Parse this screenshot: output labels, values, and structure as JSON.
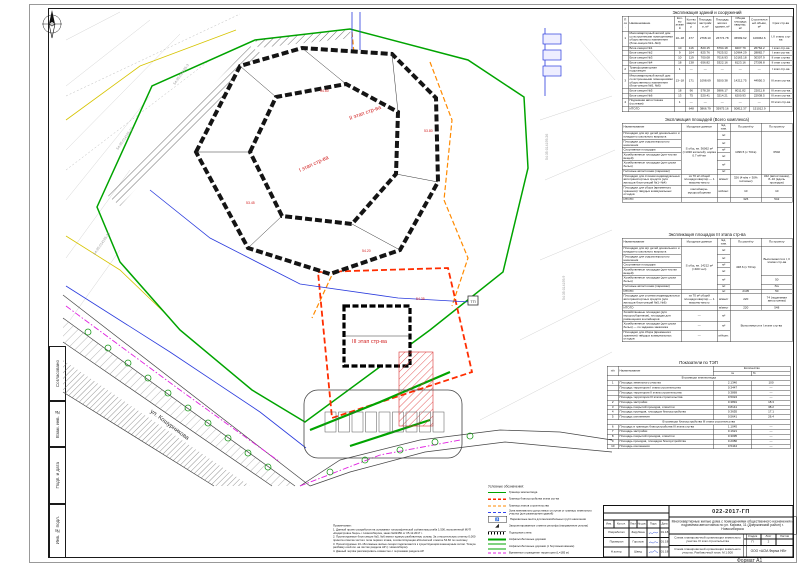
{
  "sheet": {
    "format_label": "Формат А1"
  },
  "side_stamp": {
    "cells": [
      "Согласовано",
      "Взам. инв. №",
      "Подп. и дата",
      "Инв. № подл."
    ]
  },
  "drawing": {
    "street_label": "ул. Кошурникова",
    "tp_label": "ТП",
    "stage_labels": [
      "I этап стр-ва",
      "II этап стр-ва",
      "III этап стр-ва"
    ],
    "elevation_marks": [
      "54.60",
      "53.80",
      "54.20",
      "53.45",
      "54.35"
    ],
    "cadastral_labels": [
      "54:35:014195:17",
      "54:35:014195:23",
      "54:35:014195:3",
      "54:35:014195:26",
      "54:35:014195:9"
    ]
  },
  "tables": {
    "buildings": {
      "title": "Экспликация зданий и сооружений",
      "rows": [
        [
          "Поз.",
          "Наименование",
          "Кол-во этажей",
          "Кол-во квартир",
          "Площадь застройки, м²",
          "Площадь жилого здания, м²",
          "Общая площадь квартир, м²",
          "Строительный объём, м³",
          "Срок стр-ва"
        ],
        [
          "1",
          "Многоквартирный жилой дом со встроенными помещениями общественного назначения (блок-секции №1–№4)",
          "10–18",
          "477",
          "2768.10",
          "26774.78",
          "36599.62",
          "106062.6",
          "I, II этапы стр-ва"
        ],
        [
          "",
          "Блок-секция №1",
          "10",
          "116",
          "820.15",
          "6794.18",
          "9207.79",
          "26762.2",
          "I этап стр-ва"
        ],
        [
          "",
          "Блок-секция №2",
          "9",
          "104",
          "825.76",
          "7625.52",
          "10964.29",
          "28882.7",
          "I этап стр-ва"
        ],
        [
          "",
          "Блок-секция №3",
          "10",
          "119",
          "700.08",
          "7016.93",
          "10163.18",
          "30307.9",
          "II этап стр-ва"
        ],
        [
          "",
          "Блок-секция №4",
          "18",
          "138",
          "656.82",
          "5322.16",
          "8123.16",
          "27309.8",
          "II этап стр-ва"
        ],
        [
          "2",
          "Трансформаторная подстанция",
          "1",
          "—",
          "—",
          "—",
          "—",
          "—",
          "I этап стр-ва"
        ],
        [
          "3",
          "Многоквартирный жилой дом со встроенными помещениями общественного назначения (блок-секции №5, №6)",
          "13–18",
          "171",
          "1098.69",
          "9200.38",
          "14212.75",
          "44950.3",
          "III этап стр-ва"
        ],
        [
          "",
          "Блок-секция №5",
          "18",
          "96",
          "578.28",
          "5986.17",
          "8011.82",
          "22011.8",
          "III этап стр-ва"
        ],
        [
          "",
          "Блок-секция №6",
          "13",
          "75",
          "520.41",
          "3214.21",
          "6200.93",
          "22938.5",
          "III этап стр-ва"
        ],
        [
          "4",
          "Подземная автостоянка (гостевая)",
          "1",
          "—",
          "—",
          "—",
          "—",
          "—",
          "III этап стр-ва"
        ],
        [
          "",
          "ИТОГО",
          "",
          "648",
          "3866.79",
          "35975.16",
          "50812.37",
          "151012.9",
          ""
        ]
      ]
    },
    "areas_total": {
      "title": "Экспликация площадей (Всего комплекса)",
      "rows": [
        [
          "Наименование",
          "Исходные данные",
          "Ед. изм.",
          "По расчёту",
          "По проекту"
        ],
        [
          "Площадки для игр детей дошкольного и младшего школьного возраста",
          {
            "v": "S общ. кв. 36062 м² (≈1030 жителей), норма 0.7 м²/чел",
            "rs": 6
          },
          "м²",
          {
            "v": "1096.5 (х 70/га)",
            "rs": 6
          },
          {
            "v": "6502",
            "rs": 6
          }
        ],
        [
          "Площадки для отдыха взрослого населения",
          "м²"
        ],
        [
          "Спортивные площадки",
          "м²"
        ],
        [
          "Хозяйственные площадки (для чистки вещей)",
          "м²"
        ],
        [
          "Хозяйственные площадки (для сушки белья)",
          "м²"
        ],
        [
          "Гостевые автостоянки (парковки)",
          "м²"
        ],
        [
          "Площадки для стоянки индивидуальных автотранспортных средств (для жильцов блок-секций №1–№4)",
          "из 70 м² общей площади квартир — 1 машино-место",
          "м/мест",
          "326 (4 м/м + 30% гостевых)",
          "342 (автостоянка), 8–10 (вдоль проездов)"
        ],
        [
          "Площадки для сбора (временного хранения) твёрдых коммунальных отходов",
          "контейнеры-мусоросборники",
          "м²/конт.",
          "10",
          "10"
        ],
        [
          "ИТОГО",
          "",
          "",
          "326",
          "542"
        ]
      ]
    },
    "areas_stage": {
      "title": "Экспликация площадок III этапа стр-ва",
      "rows": [
        [
          "Наименование",
          "Исходные данные",
          "Ед. изм.",
          "По расчёту",
          "По проекту"
        ],
        [
          "Площадки для игр детей дошкольного и младшего школьного возраста",
          {
            "v": "S общ. кв. 14212 м² (≈400 чел)",
            "rs": 6
          },
          "м²",
          {
            "v": "438.6 (х 70/га)",
            "rs": 6
          },
          {
            "v": "Выполняются в I, II этапах стр-ва",
            "rs": 4
          }
        ],
        [
          "Площадки для отдыха взрослого населения",
          "м²"
        ],
        [
          "Спортивные площадки",
          "м²"
        ],
        [
          "Хозяйственные площадки (для чистки вещей)",
          "м²"
        ],
        [
          "Хозяйственные площадки (для сушки белья)",
          "м²",
          "50"
        ],
        [
          "Гостевые автостоянки (парковки)",
          "м²",
          "б/н"
        ],
        [
          "ИТОГО",
          "",
          "м²",
          "2105",
          "50"
        ],
        [
          "Площадки для стоянки индивидуальных автотранспортных средств (для жильцов блок-секций №5, №6)",
          "из 70 м² общей площади квартир — 1 машино-место",
          "м/мест",
          "220",
          "74 (подземная автостоянка)"
        ],
        [
          "ИТОГО",
          "",
          "м/мест",
          "220",
          "548"
        ],
        [
          "Хозяйственные площадки (для мусоросборников), площадки для размещения контейнеров",
          "—",
          "м²",
          {
            "v": "Выполняются в I этапе стр-ва",
            "cs": 2,
            "rs": 3,
            "c": 1
          }
        ],
        [
          "Хозяйственные площадки (для сушки белья) — по заданию заказчика",
          "—",
          "м²"
        ],
        [
          "Площадки для сбора (временного хранения) твёрдых коммунальных отходов",
          "—",
          "м²/конт."
        ]
      ]
    },
    "tep": {
      "title": "Показатели по ТЭП",
      "rows": [
        [
          {
            "v": "п/п",
            "rs": 2
          },
          {
            "v": "Наименование",
            "rs": 2
          },
          {
            "v": "Количество",
            "cs": 2
          }
        ],
        [
          "га",
          "%"
        ],
        [
          {
            "v": "В границах землеотвода",
            "cs": 4,
            "c": 1
          }
        ],
        [
          "1",
          "Площадь земельного участка",
          "2.1340",
          "100"
        ],
        [
          "",
          "Площадь территории I этапа строительства",
          "0.3447",
          "—"
        ],
        [
          "",
          "Площадь территории II этапа строительства",
          "0.3869",
          "—"
        ],
        [
          "",
          "Площадь территории III этапа строительства",
          "0.5024",
          "—"
        ],
        [
          "2",
          "Площадь застройки",
          "0.3891",
          "18.3"
        ],
        [
          "3",
          "Площадь покрытий проездов, отмостки",
          "0.8141",
          "38.2"
        ],
        [
          "4",
          "Площадь проездов, площадок благоустройства",
          "0.3655",
          "17.1"
        ],
        [
          "5",
          "Площадь озеленения",
          "0.5641",
          "26.4"
        ],
        [
          {
            "v": "В границах благоустройства III этапа строительства",
            "cs": 4,
            "c": 1
          }
        ],
        [
          "6",
          "Площадь в границах благоустройства III этапа стр-ва",
          "1.1045",
          "—"
        ],
        [
          "7",
          "Площадь застройки",
          "0.1621",
          "—"
        ],
        [
          "8",
          "Площадь покрытий проездов, отмостки",
          "0.3095",
          "—"
        ],
        [
          "9",
          "Площадь проездов, площадок благоустройства",
          "0.2080",
          "—"
        ],
        [
          "10",
          "Площадь озеленения",
          "0.5444",
          "—"
        ]
      ]
    }
  },
  "legend": {
    "title": "Условные обозначения:",
    "items": [
      {
        "label": "Граница землеотвода"
      },
      {
        "label": "Граница благоустройства этапа стр-ва"
      },
      {
        "label": "Граница этапов строительства"
      },
      {
        "label": "Зона минимально допустимых отступов от границы земельного участка (для размещения зданий)"
      },
      {
        "label": "Парковочные места для маломобильных групп населения",
        "glyph": "♿"
      },
      {
        "label": "Запроектированные отметки рельефа (направление уклона)",
        "glyph": "◢"
      },
      {
        "label": "Подпорная стена"
      },
      {
        "label": "Асфальтобетонные дорожки"
      },
      {
        "label": "Асфальтобетонные дорожки (с бортовым камнем)"
      },
      {
        "label": "Временное ограждение территории (L=185 м)"
      }
    ]
  },
  "notes": {
    "title": "Примечание:",
    "items": [
      "1. Данный проект разработан на основании топографической съёмки масштаба 1:500, выполненной МУП «Кадастровое бюро» г. Новосибирска, заказ №02456 от 05.12.2017 г.",
      "2. Проектируемые блок-секции №5, №6 имеют единую разбивочную основу. За относительную отметку 0,000 принята отметка чистого пола первого этажа, соответствующая абсолютной отметке 54.60 по генплану.",
      "3. Проектируемые 13–18-этажные жилые секции подключаются к существующим инженерным сетям. Точную разбивку осей см. на листах раздела АР (г. Новосибирск).",
      "4. Данный чертёж рассматривать совместно с чертежами раздела АР."
    ]
  },
  "titleblock": {
    "doc_code": "022-2017-ГП",
    "project_name": "Многоквартирные жилые дома с помещениями общественного назначения и подземная автостоянка по ул. Кирова, 11 (Дзержинский район) г. Новосибирска",
    "sheet_title": "Схема планировочной организации земельного участка. III этап строительства",
    "sheet_subtitle": "Схема планировочной организации земельного участка. Разбивочный план. М 1:500",
    "head_cols": [
      "Изм.",
      "Кол.уч.",
      "Лист",
      "№ док.",
      "Подп.",
      "Дата"
    ],
    "sig_rows": [
      {
        "role": "Разработал",
        "name": "Зарубина",
        "date": "01.18"
      },
      {
        "role": "Проверил",
        "name": "Горохов",
        "date": "01.18"
      },
      {
        "role": "Н.контр.",
        "name": "Швед",
        "date": "01.18"
      }
    ],
    "stage_label": "Стадия",
    "stage_value": "П",
    "list_label": "Лист",
    "list_value": "2",
    "lists_label": "Листов",
    "lists_value": "",
    "company": "ООО «АСМ-Фирма НВ»"
  }
}
